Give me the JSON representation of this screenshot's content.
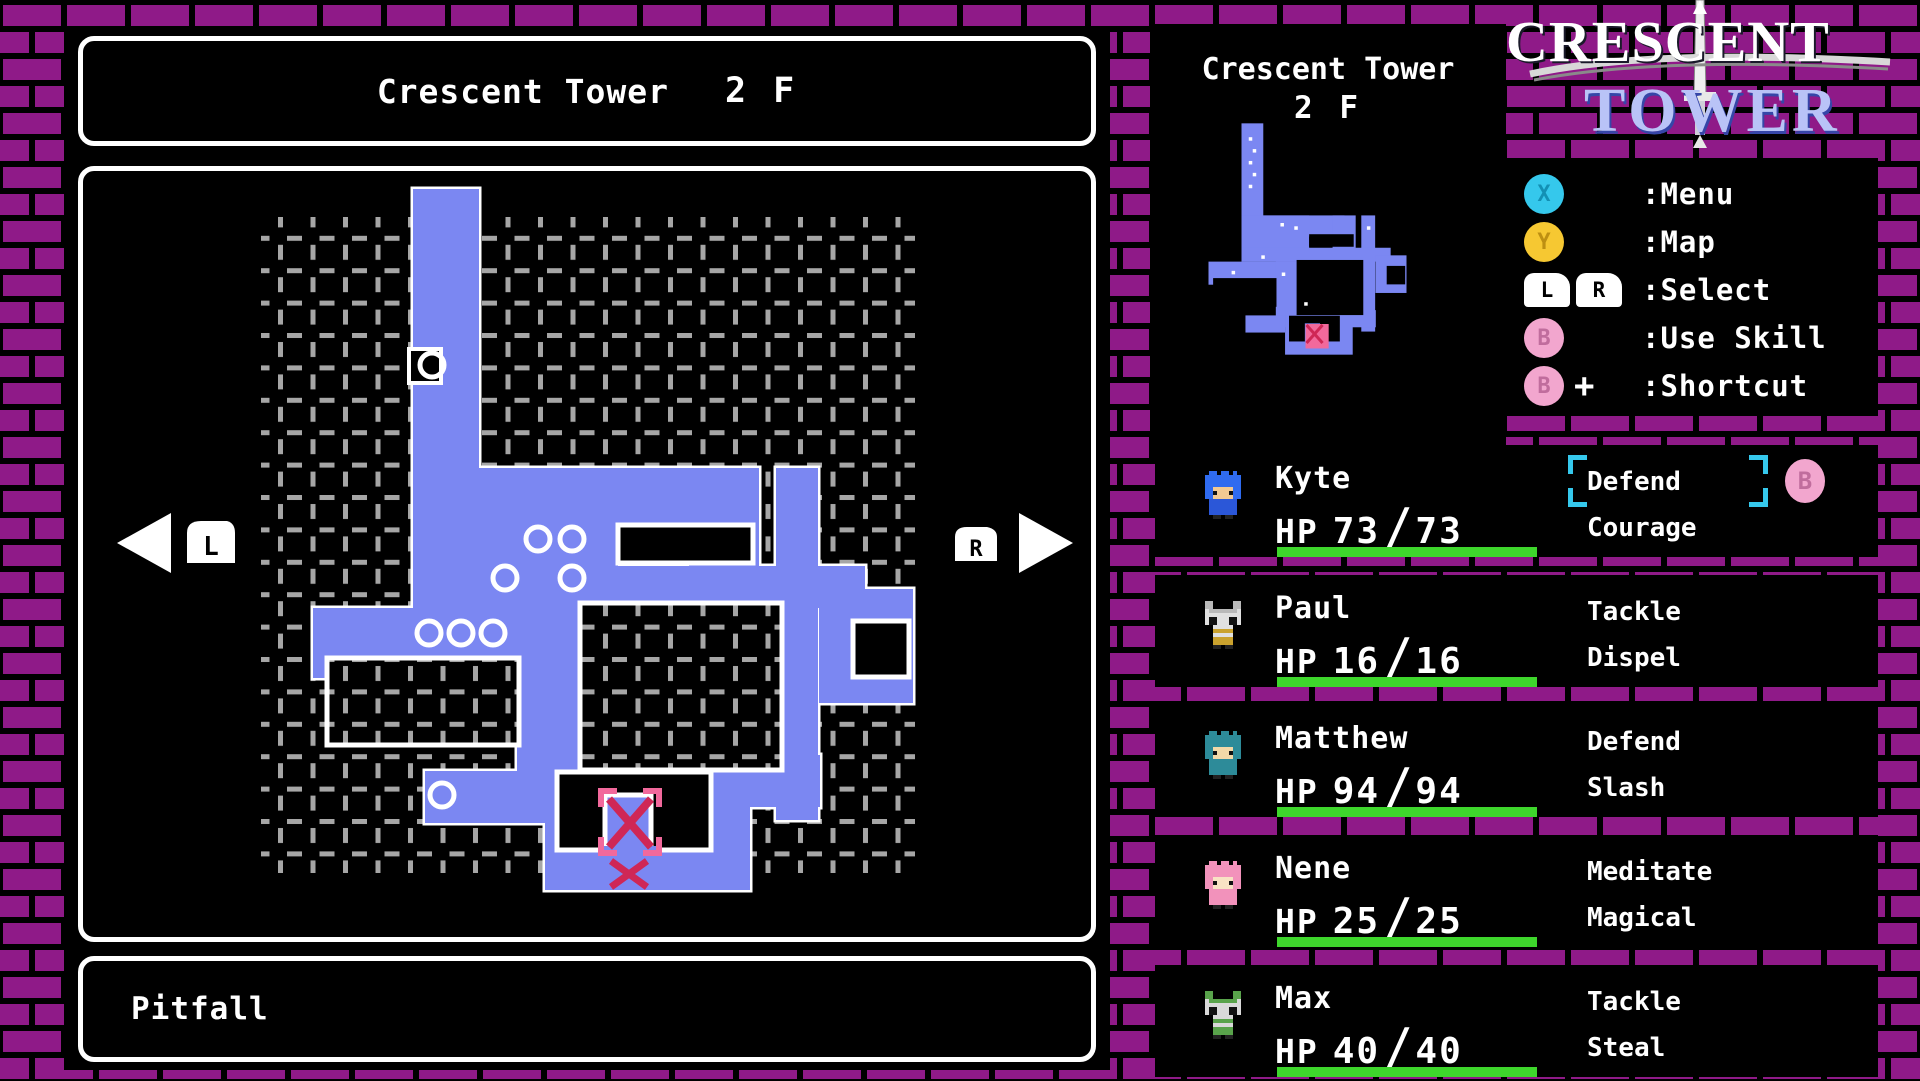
{
  "colors": {
    "brick": "#8f1a88",
    "map_blue": "#7b87f2",
    "dash_gray": "#a6a6a6",
    "hp_green": "#3ed62c",
    "marker_pink": "#f2699c",
    "marker_red": "#cf2756",
    "select_cyan": "#35c8ec",
    "button_cyan": "#35c8ec",
    "button_yellow": "#f6c832",
    "button_pink": "#f2a6ce"
  },
  "banner": {
    "location": "Crescent Tower",
    "floor": "2 F"
  },
  "status": {
    "text": "Pitfall"
  },
  "nav": {
    "left_button": "L",
    "right_button": "R"
  },
  "minimap": {
    "title": "Crescent Tower",
    "floor": "2 F"
  },
  "logo": {
    "line1": "CRESCENT",
    "line2": "TOWER"
  },
  "legend": {
    "rows": [
      {
        "label": ":Menu",
        "buttons": [
          {
            "text": "X",
            "type": "round",
            "bg": "#35c8ec",
            "fg": "#1390b4"
          }
        ]
      },
      {
        "label": ":Map",
        "buttons": [
          {
            "text": "Y",
            "type": "round",
            "bg": "#f6c832",
            "fg": "#bd8f12"
          }
        ]
      },
      {
        "label": ":Select",
        "buttons": [
          {
            "text": "L",
            "type": "shoulder"
          },
          {
            "text": "R",
            "type": "shoulder"
          }
        ]
      },
      {
        "label": ":Use Skill",
        "buttons": [
          {
            "text": "B",
            "type": "round",
            "bg": "#f2a6ce",
            "fg": "#c06d9d"
          }
        ]
      },
      {
        "label": ":Shortcut",
        "buttons": [
          {
            "text": "B",
            "type": "round",
            "bg": "#f2a6ce",
            "fg": "#c06d9d"
          }
        ],
        "suffix": "+"
      }
    ]
  },
  "party": [
    {
      "name": "Kyte",
      "hp_label": "HP",
      "hp_current": "73",
      "hp_max": "73",
      "hp_pct": 100,
      "skills": [
        "Defend",
        "Courage"
      ],
      "selected": true,
      "badge": "B",
      "sprite": {
        "type": "hero",
        "hair": "#2f6bf0",
        "skin": "#f2c992",
        "body": "#2b57d8"
      }
    },
    {
      "name": "Paul",
      "hp_label": "HP",
      "hp_current": "16",
      "hp_max": "16",
      "hp_pct": 100,
      "skills": [
        "Tackle",
        "Dispel"
      ],
      "selected": false,
      "sprite": {
        "type": "cat",
        "hair": "#b9b9b9",
        "skin": "#e0e0e0",
        "body": "#caa22e"
      }
    },
    {
      "name": "Matthew",
      "hp_label": "HP",
      "hp_current": "94",
      "hp_max": "94",
      "hp_pct": 100,
      "skills": [
        "Defend",
        "Slash"
      ],
      "selected": false,
      "sprite": {
        "type": "hero",
        "hair": "#2d8b99",
        "skin": "#f2d9a8",
        "body": "#2d8b99"
      }
    },
    {
      "name": "Nene",
      "hp_label": "HP",
      "hp_current": "25",
      "hp_max": "25",
      "hp_pct": 100,
      "skills": [
        "Meditate",
        "Magical"
      ],
      "selected": false,
      "sprite": {
        "type": "hero",
        "hair": "#f292bb",
        "skin": "#f8e2c4",
        "body": "#f292bb"
      }
    },
    {
      "name": "Max",
      "hp_label": "HP",
      "hp_current": "40",
      "hp_max": "40",
      "hp_pct": 100,
      "skills": [
        "Tackle",
        "Steal"
      ],
      "selected": false,
      "sprite": {
        "type": "cat",
        "hair": "#59a34b",
        "skin": "#d9d9d9",
        "body": "#59a34b"
      }
    }
  ],
  "map": {
    "grid": [
      178,
      46,
      654,
      656
    ],
    "blue": [
      [
        330,
        18,
        66,
        282
      ],
      [
        330,
        297,
        312,
        64
      ],
      [
        330,
        297,
        205,
        140
      ],
      [
        606,
        297,
        70,
        102
      ],
      [
        693,
        297,
        42,
        352
      ],
      [
        330,
        395,
        452,
        42
      ],
      [
        230,
        437,
        272,
        70
      ],
      [
        434,
        437,
        68,
        182
      ],
      [
        736,
        418,
        94,
        114
      ],
      [
        462,
        584,
        275,
        52
      ],
      [
        462,
        601,
        205,
        118
      ],
      [
        342,
        600,
        120,
        52
      ]
    ],
    "rooms": [
      {
        "r": [
          535,
          354,
          135,
          38
        ],
        "dash": false
      },
      {
        "r": [
          497,
          432,
          202,
          167
        ],
        "dash": true
      },
      {
        "r": [
          244,
          487,
          192,
          87
        ],
        "dash": true
      },
      {
        "r": [
          474,
          601,
          154,
          78
        ],
        "dash": false
      },
      {
        "r": [
          770,
          450,
          56,
          56
        ],
        "dash": false
      }
    ],
    "notch": [
      326,
      178,
      32,
      34
    ],
    "inlet": [
      522,
      624,
      46,
      55
    ],
    "circles": [
      [
        349,
        194
      ],
      [
        455,
        368
      ],
      [
        489,
        368
      ],
      [
        422,
        407
      ],
      [
        489,
        407
      ],
      [
        346,
        462
      ],
      [
        378,
        462
      ],
      [
        410,
        462
      ],
      [
        359,
        624
      ]
    ],
    "marker": {
      "bracket": [
        518,
        620,
        58,
        62
      ],
      "x1": [
        526,
        628,
        42,
        48
      ],
      "x2": [
        528,
        690,
        36,
        26
      ]
    },
    "speckles": [
      [
        352,
        60
      ],
      [
        364,
        96
      ],
      [
        352,
        132
      ],
      [
        364,
        168
      ],
      [
        352,
        204
      ],
      [
        448,
        320
      ],
      [
        490,
        330
      ],
      [
        390,
        418
      ],
      [
        452,
        470
      ],
      [
        300,
        465
      ],
      [
        520,
        560
      ],
      [
        710,
        330
      ]
    ]
  }
}
